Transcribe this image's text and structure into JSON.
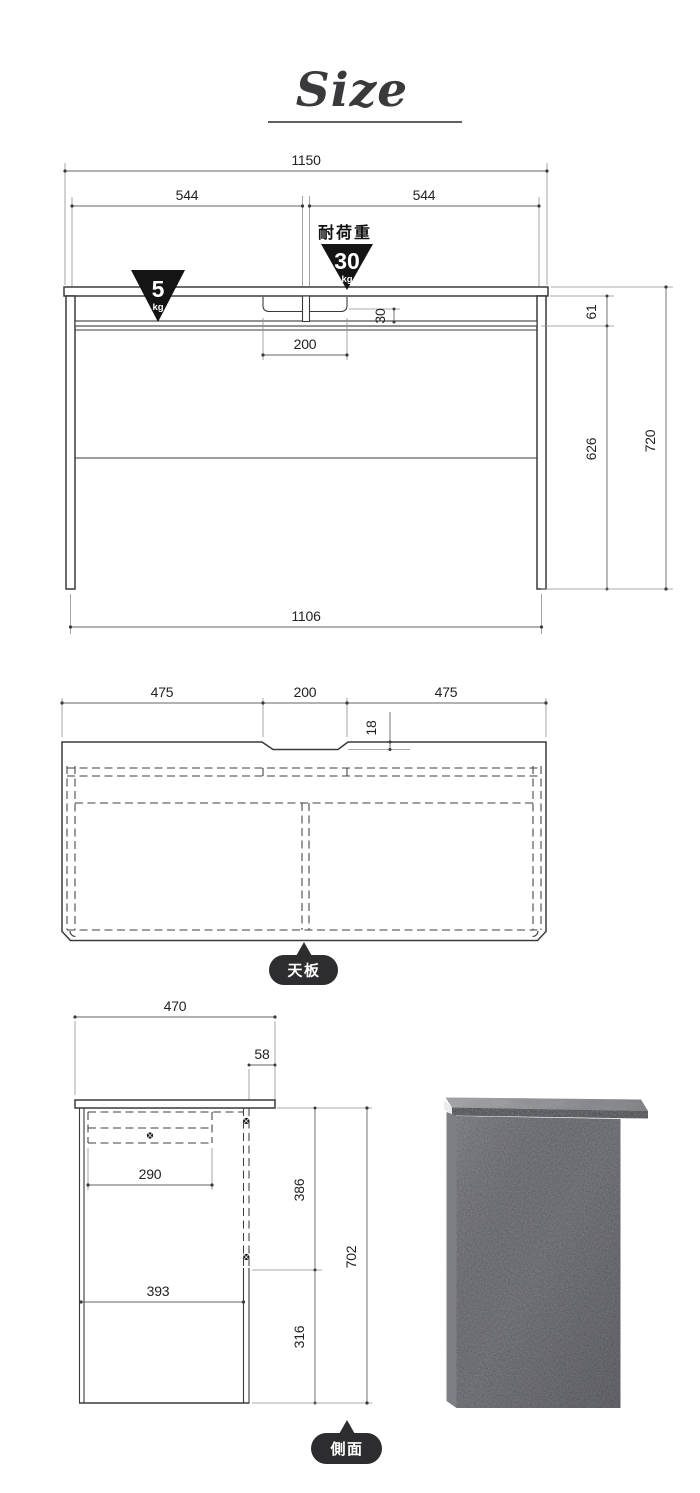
{
  "title": "Size",
  "front_view": {
    "dim_total_width": "1150",
    "dim_left_span": "544",
    "dim_right_span": "544",
    "load_capacity_label": "耐荷重",
    "load_top_value": "30",
    "load_top_unit": "kg",
    "load_shelf_value": "5",
    "load_shelf_unit": "kg",
    "dim_tray_depth": "30",
    "dim_tray_width": "200",
    "dim_apron_height": "61",
    "dim_leg_clearance": "626",
    "dim_total_height": "720",
    "dim_inner_width": "1106"
  },
  "top_view": {
    "dim_left_span": "475",
    "dim_notch_width": "200",
    "dim_right_span": "475",
    "dim_notch_depth": "18",
    "badge_label": "天板"
  },
  "side_view": {
    "dim_total_depth": "470",
    "dim_top_overhang": "58",
    "dim_shelf_depth": "290",
    "dim_upper_height": "386",
    "dim_panel_depth": "393",
    "dim_lower_height": "316",
    "dim_total_height": "702",
    "badge_label": "側面"
  },
  "colors": {
    "accent_black": "#141414",
    "badge_bg": "#2d2d2f",
    "line": "#3a3a3a",
    "photo_panel": "#55565b"
  }
}
